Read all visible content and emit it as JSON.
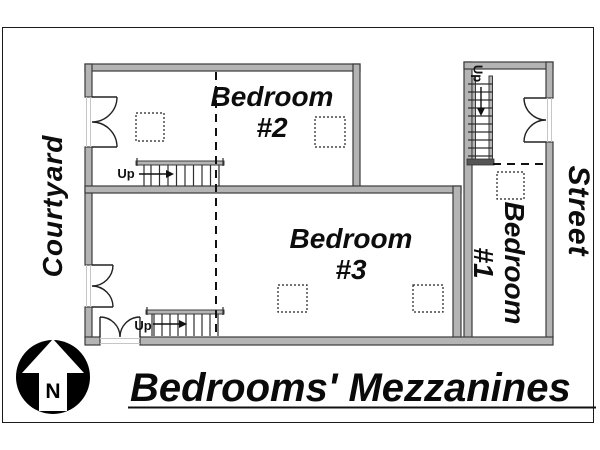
{
  "title": "Bedrooms' Mezzanines",
  "environment": {
    "left_label": "Courtyard",
    "right_label": "Street"
  },
  "rooms": [
    {
      "name": "Bedroom",
      "number": "#2"
    },
    {
      "name": "Bedroom",
      "number": "#3"
    },
    {
      "name": "Bedroom",
      "number": "#1"
    }
  ],
  "stairs": [
    {
      "label": "Up"
    },
    {
      "label": "Up"
    },
    {
      "label": "Up"
    }
  ],
  "compass": {
    "north": "N"
  },
  "colors": {
    "background": "#ffffff",
    "wall_fill": "#b4b4b4",
    "wall_stroke": "#3b3b3b",
    "line": "#111111"
  }
}
